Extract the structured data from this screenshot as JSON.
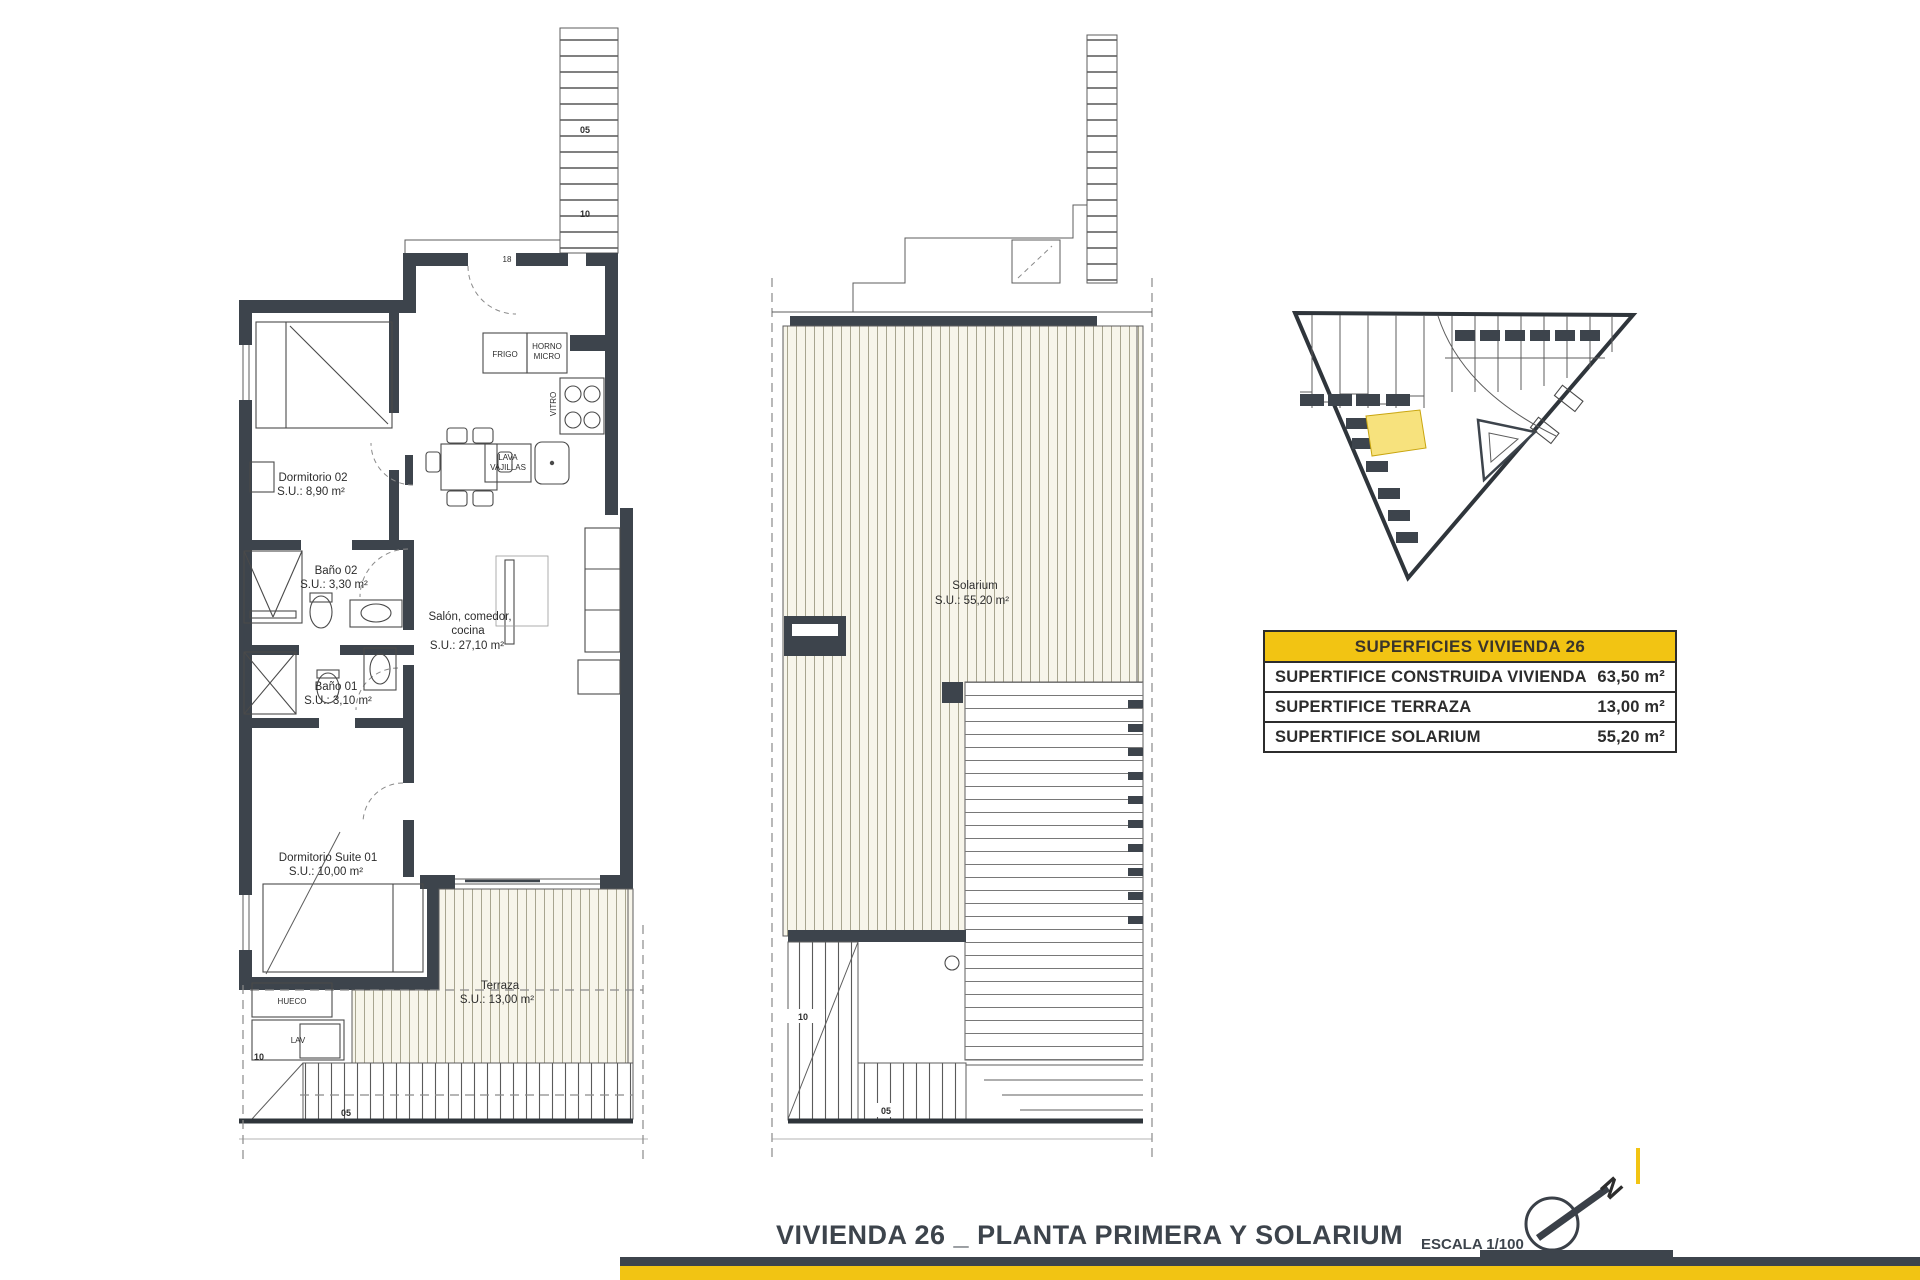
{
  "title_block": {
    "title": "VIVIENDA 26 _ PLANTA PRIMERA Y SOLARIUM",
    "scale": "ESCALA 1/100",
    "north_letter": "N"
  },
  "areas_table": {
    "header": "SUPERFICIES VIVIENDA 26",
    "rows": [
      {
        "label": "SUPERTIFICE CONSTRUIDA VIVIENDA",
        "value": "63,50 m²"
      },
      {
        "label": "SUPERTIFICE TERRAZA",
        "value": "13,00 m²"
      },
      {
        "label": "SUPERTIFICE SOLARIUM",
        "value": "55,20 m²"
      }
    ]
  },
  "first_floor": {
    "dormitorio02": {
      "name": "Dormitorio 02",
      "area": "S.U.: 8,90 m²"
    },
    "bano02": {
      "name": "Baño 02",
      "area": "S.U.: 3,30 m²"
    },
    "bano01": {
      "name": "Baño 01",
      "area": "S.U.: 3,10 m²"
    },
    "salon": {
      "line1": "Salón, comedor,",
      "line2": "cocina",
      "area": "S.U.: 27,10 m²"
    },
    "suite": {
      "name": "Dormitorio Suite 01",
      "area": "S.U.: 10,00 m²"
    },
    "terraza": {
      "name": "Terraza",
      "area": "S.U.: 13,00 m²"
    },
    "kitchen": {
      "frigo": "FRIGO",
      "horno1": "HORNO",
      "horno2": "MICRO",
      "vitro": "VITRO",
      "lava1": "LAVA",
      "lava2": "VAJILLAS"
    },
    "utility": {
      "hueco": "HUECO",
      "lav": "LAV"
    },
    "stairs": {
      "top_05": "05",
      "top_10": "10",
      "top_18": "18",
      "lower_10": "10",
      "lower_05": "05"
    }
  },
  "solarium_floor": {
    "solarium": {
      "name": "Solarium",
      "area": "S.U.: 55,20 m²"
    },
    "stairs": {
      "s10": "10",
      "s05": "05"
    }
  },
  "colors": {
    "wall_dark": "#3d444c",
    "accent_yellow": "#f2c413",
    "highlight_yellow": "#f7e27d",
    "deck_fill": "#f7f5ea",
    "deck_line": "#a8a58f"
  }
}
